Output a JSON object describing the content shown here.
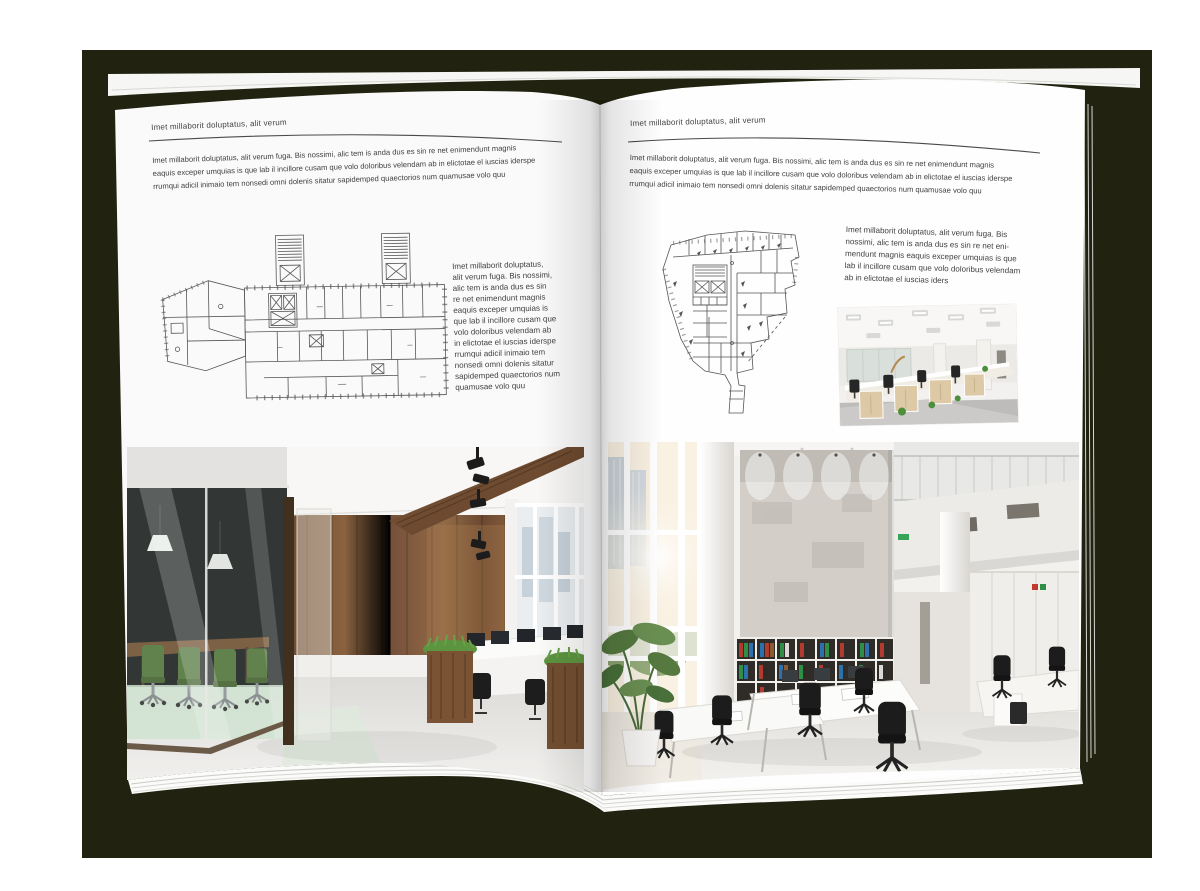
{
  "colors": {
    "backdrop": "#21220f",
    "page": "#ffffff",
    "text": "#3f3f3f",
    "rule": "#4a4a4a"
  },
  "left_page": {
    "header": "Imet millaborit doluptatus, alit verum",
    "intro": "Imet millaborit doluptatus, alit verum fuga. Bis nossimi, alic tem is anda dus es sin re net enimendunt magnis\neaquis exceper umquias is que lab il incillore cusam que volo doloribus velendam ab in elictotae el iuscias iderspe\nrrumqui adicil inimaio tem nonsedi omni dolenis sitatur sapidemped quaectorios num quamusae volo quu",
    "side_text": "Imet millaborit doluptatus,\nalit verum fuga. Bis nossimi,\nalic tem is anda dus es sin\nre net enimendunt magnis\neaquis exceper umquias is\nque lab il incillore cusam que\nvolo doloribus velendam ab\nin elictotae el iuscias iderspe\nrrumqui adicil inimaio tem\nnonsedi omni dolenis sitatur\nsapidemped quaectorios num\nquamusae volo quu"
  },
  "right_page": {
    "header": "Imet millaborit doluptatus, alit verum",
    "intro": "Imet millaborit doluptatus, alit verum fuga. Bis nossimi, alic tem is anda dus es sin re net enimendunt magnis\neaquis exceper umquias is que lab il incillore cusam que volo doloribus velendam ab in elictotae el iuscias iderspe\nrrumqui adicil inimaio tem nonsedi omni dolenis sitatur sapidemped quaectorios num quamusae volo quu",
    "side_text": "Imet millaborit doluptatus, alit verum fuga. Bis\nnossimi, alic tem is anda dus es sin re net eni-\nmendunt magnis eaquis exceper umquias is que\nlab il incillore cusam que volo doloribus velendam\nab in elictotae el iuscias iders"
  }
}
